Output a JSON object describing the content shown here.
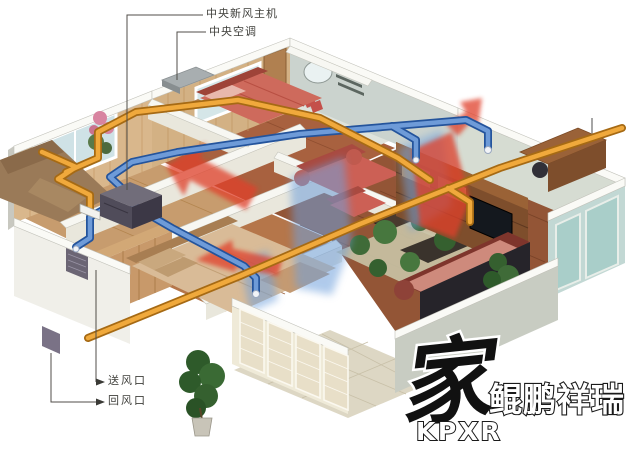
{
  "callouts": {
    "main_unit": "中央新风主机",
    "central_ac": "中央空调",
    "supply_vent": "送风口",
    "return_vent": "回风口"
  },
  "logo": {
    "glyph": "家",
    "brand": "鲲鹏祥瑞",
    "abbr": "KPXR"
  },
  "palette": {
    "supply_duct_orange": "#F0A93C",
    "return_duct_blue": "#5B8FD4",
    "warm_airflow_red": "#E0402A",
    "cool_airflow_blue": "#6FA0DC",
    "unit_gray": "#504C5A",
    "wall_wood": "#D9B78C",
    "background": "#FFFFFF"
  }
}
